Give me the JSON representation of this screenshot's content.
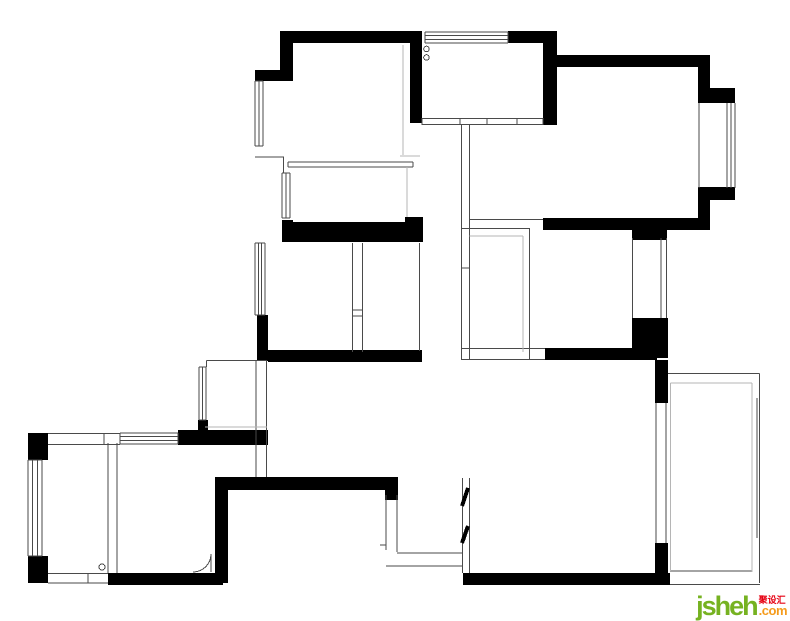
{
  "watermark": {
    "brand": "jsheh",
    "suffix": ".com",
    "cjk": "聚设汇",
    "brand_color": "#76b221",
    "suffix_color": "#f59b1c",
    "cjk_color": "#e60012"
  },
  "floorplan": {
    "background": "#ffffff",
    "wall_color": "#000000",
    "line_color": "#4a4a4a",
    "light_color": "#b5b5b5",
    "walls": [
      [
        280,
        31,
        140,
        12
      ],
      [
        280,
        31,
        13,
        40
      ],
      [
        255,
        70,
        38,
        11
      ],
      [
        410,
        31,
        12,
        92
      ],
      [
        508,
        31,
        49,
        12
      ],
      [
        543,
        31,
        14,
        94
      ],
      [
        551,
        55,
        159,
        12
      ],
      [
        698,
        55,
        12,
        48
      ],
      [
        707,
        88,
        28,
        15
      ],
      [
        707,
        187,
        28,
        13
      ],
      [
        698,
        187,
        12,
        43
      ],
      [
        543,
        218,
        167,
        12
      ],
      [
        632,
        225,
        35,
        15
      ],
      [
        282,
        220,
        11,
        22
      ],
      [
        282,
        222,
        141,
        20
      ],
      [
        405,
        217,
        18,
        25
      ],
      [
        257,
        315,
        11,
        46
      ],
      [
        268,
        350,
        154,
        12
      ],
      [
        545,
        348,
        112,
        12
      ],
      [
        632,
        318,
        36,
        40
      ],
      [
        655,
        360,
        13,
        43
      ],
      [
        655,
        543,
        13,
        42
      ],
      [
        463,
        573,
        207,
        12
      ],
      [
        28,
        433,
        20,
        27
      ],
      [
        28,
        556,
        20,
        27
      ],
      [
        178,
        430,
        90,
        15
      ],
      [
        198,
        420,
        10,
        12
      ],
      [
        215,
        477,
        13,
        106
      ],
      [
        215,
        477,
        183,
        13
      ],
      [
        385,
        477,
        13,
        23
      ],
      [
        108,
        573,
        115,
        12
      ]
    ],
    "windows": [
      {
        "x": 425,
        "y": 32,
        "w": 83,
        "h": 11,
        "dir": "h",
        "n": 4
      },
      {
        "x": 255,
        "y": 81,
        "w": 8,
        "h": 65,
        "dir": "v",
        "n": 3
      },
      {
        "x": 282,
        "y": 173,
        "w": 8,
        "h": 45,
        "dir": "v",
        "n": 3
      },
      {
        "x": 255,
        "y": 243,
        "w": 10,
        "h": 72,
        "dir": "v",
        "n": 4
      },
      {
        "x": 199,
        "y": 367,
        "w": 7,
        "h": 53,
        "dir": "v",
        "n": 3
      },
      {
        "x": 120,
        "y": 433,
        "w": 58,
        "h": 11,
        "dir": "h",
        "n": 4
      },
      {
        "x": 28,
        "y": 460,
        "w": 14,
        "h": 96,
        "dir": "v",
        "n": 4
      },
      {
        "x": 727,
        "y": 103,
        "w": 8,
        "h": 85,
        "dir": "v",
        "n": 3
      }
    ],
    "lines": [
      [
        422,
        118.5,
        543,
        118.5,
        "t"
      ],
      [
        422,
        124.5,
        543,
        124.5,
        "t"
      ],
      [
        460,
        118,
        460,
        125,
        "t"
      ],
      [
        487,
        118,
        487,
        125,
        "t"
      ],
      [
        517,
        118,
        517,
        125,
        "t"
      ],
      [
        422,
        118,
        422,
        125,
        "t"
      ],
      [
        543,
        118,
        543,
        125,
        "t"
      ],
      [
        288,
        162,
        413,
        162,
        "t"
      ],
      [
        288,
        167,
        413,
        167,
        "t"
      ],
      [
        288,
        162,
        288,
        167,
        "t"
      ],
      [
        413,
        162,
        413,
        167,
        "t"
      ],
      [
        255,
        157,
        284,
        157,
        "t"
      ],
      [
        283.5,
        157,
        283.5,
        173,
        "t"
      ],
      [
        255,
        146,
        263,
        146,
        "t"
      ],
      [
        352.5,
        243,
        352.5,
        352,
        "t"
      ],
      [
        362.5,
        243,
        362.5,
        352,
        "t"
      ],
      [
        352,
        310,
        363,
        310,
        "t"
      ],
      [
        352,
        316,
        363,
        316,
        "t"
      ],
      [
        419.5,
        243,
        419.5,
        351,
        "t"
      ],
      [
        461.5,
        125,
        461.5,
        360,
        "t"
      ],
      [
        469.5,
        125,
        469.5,
        360,
        "t"
      ],
      [
        529.5,
        228,
        529.5,
        360,
        "t"
      ],
      [
        461.5,
        228.5,
        529.5,
        228.5,
        "t"
      ],
      [
        461.5,
        268,
        469.5,
        268,
        "t"
      ],
      [
        462,
        348.5,
        545,
        348.5,
        "t"
      ],
      [
        462,
        359.5,
        545,
        359.5,
        "t"
      ],
      [
        470,
        219.5,
        543,
        219.5,
        "t"
      ],
      [
        256,
        360,
        256,
        477,
        "t"
      ],
      [
        266.5,
        360,
        266.5,
        477,
        "t"
      ],
      [
        206.5,
        360.5,
        266.5,
        360.5,
        "t"
      ],
      [
        206.5,
        360.5,
        206.5,
        367,
        "t"
      ],
      [
        48,
        433.5,
        120,
        433.5,
        "t"
      ],
      [
        48,
        444.5,
        120,
        444.5,
        "t"
      ],
      [
        104,
        433,
        104,
        445,
        "t"
      ],
      [
        108,
        443,
        108,
        573,
        "t"
      ],
      [
        117,
        443,
        117,
        573,
        "t"
      ],
      [
        48,
        573.5,
        108,
        573.5,
        "t"
      ],
      [
        48,
        583,
        108,
        583,
        "t"
      ],
      [
        88,
        573,
        88,
        583,
        "t"
      ],
      [
        211,
        554,
        211,
        572,
        "t"
      ],
      [
        386,
        495,
        386,
        550,
        "t"
      ],
      [
        397,
        495,
        397,
        552,
        "t"
      ],
      [
        397,
        553,
        463,
        553,
        "t"
      ],
      [
        386,
        566,
        463,
        566,
        "t"
      ],
      [
        380,
        545,
        386,
        545,
        "t"
      ],
      [
        462.5,
        478,
        462.5,
        573,
        "t"
      ],
      [
        469.5,
        478,
        469.5,
        573,
        "t"
      ],
      [
        656,
        403,
        656,
        543,
        "t"
      ],
      [
        666,
        403,
        666,
        543,
        "t"
      ],
      [
        632.5,
        238,
        632.5,
        318,
        "t"
      ],
      [
        661,
        238,
        661,
        318,
        "t"
      ],
      [
        666.5,
        238,
        666.5,
        318,
        "t"
      ],
      [
        668,
        373.5,
        759.5,
        373.5,
        "t"
      ],
      [
        759.5,
        373.5,
        759.5,
        583,
        "t"
      ],
      [
        670,
        584.5,
        760,
        584.5,
        "t"
      ],
      [
        752,
        398,
        752,
        538,
        "t"
      ],
      [
        757,
        398,
        757,
        538,
        "t"
      ],
      [
        670,
        571,
        752,
        571,
        "t"
      ],
      [
        699,
        103,
        699,
        188,
        "t"
      ],
      [
        425,
        32,
        425,
        43,
        "t"
      ],
      [
        508,
        32,
        508,
        43,
        "t"
      ],
      [
        255,
        81,
        263,
        81,
        "t"
      ],
      [
        255,
        243,
        265,
        243,
        "t"
      ],
      [
        255,
        315,
        265,
        315,
        "t"
      ],
      [
        120,
        433,
        120,
        444,
        "t"
      ],
      [
        178,
        433,
        178,
        444,
        "t"
      ],
      [
        28,
        460,
        42,
        460,
        "t"
      ],
      [
        28,
        556,
        42,
        556,
        "t"
      ],
      [
        282,
        173,
        290,
        173,
        "t"
      ],
      [
        282,
        218,
        290,
        218,
        "t"
      ],
      [
        199,
        367,
        206,
        367,
        "t"
      ],
      [
        199,
        420,
        206,
        420,
        "t"
      ],
      [
        403,
        45,
        403,
        155,
        "l"
      ],
      [
        400,
        156,
        420,
        156,
        "l"
      ],
      [
        407,
        167,
        407,
        217,
        "l"
      ],
      [
        469.5,
        236,
        523,
        236,
        "l"
      ],
      [
        523,
        236,
        523,
        352,
        "l"
      ],
      [
        205,
        427,
        267,
        427,
        "l"
      ],
      [
        670.5,
        383,
        752,
        383,
        "l"
      ],
      [
        752,
        383,
        752,
        572,
        "l"
      ],
      [
        670.5,
        383,
        670.5,
        571,
        "l"
      ]
    ],
    "circles": [
      [
        426.5,
        49,
        2.8
      ],
      [
        426.5,
        57.5,
        2.8
      ],
      [
        102,
        567,
        3
      ]
    ],
    "arcs": [
      "M 211 554 A 18 18 0 0 1 193 572"
    ],
    "slashes": [
      [
        462,
        506,
        468,
        488
      ],
      [
        462,
        543,
        468,
        526
      ]
    ]
  }
}
